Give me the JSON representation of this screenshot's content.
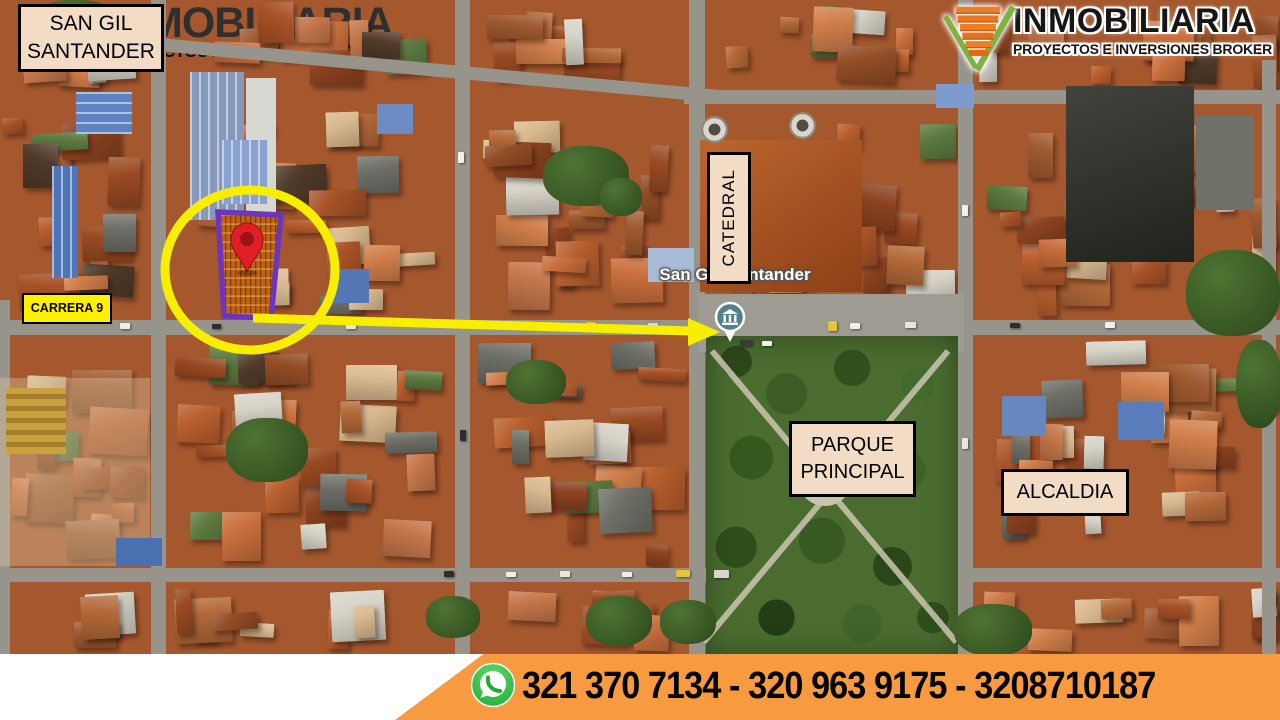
{
  "badge": {
    "line1": "SAN GIL",
    "line2": "SANTANDER"
  },
  "header_logo": {
    "brand_name": "INMOBILIARIA",
    "tagline": "PROYECTOS E INVERSIONES BROKER"
  },
  "map": {
    "city_label": "San Gil, Santander",
    "street_label": "CARRERA 9",
    "cathedral_label": "CATEDRAL",
    "park_label_line1": "PARQUE",
    "park_label_line2": "PRINCIPAL",
    "city_hall_label": "ALCALDIA"
  },
  "footer": {
    "brand_name": "INMOBILIARIA",
    "tagline": "PROYECTOS E INVERSIONES BROKER",
    "phone_numbers": "321 370 7134 - 320 963 9175 - 3208710187"
  },
  "icons": {
    "brand_logo": "v-check-building-logo-icon",
    "whatsapp": "whatsapp-icon",
    "pin": "location-pin-icon",
    "poi": "town-hall-poi-icon",
    "highlight": "yellow-circle-highlight",
    "arrow": "yellow-arrow"
  },
  "colors": {
    "accent_yellow": "#F8EE00",
    "label_cream": "#F3DCC6",
    "highlight_purple": "#6D35B8",
    "footer_orange": "#F79A40",
    "whatsapp_green": "#2BB33A",
    "pin_red": "#E01E25",
    "poi_teal": "#53808F"
  }
}
